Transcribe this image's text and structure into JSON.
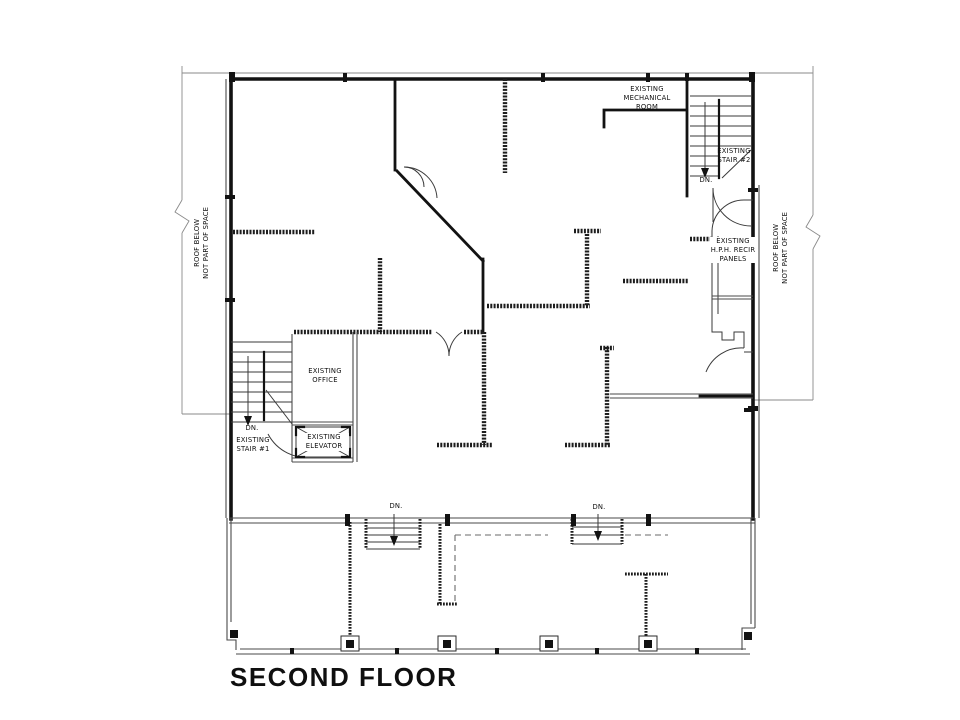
{
  "drawing": {
    "title": "SECOND FLOOR",
    "colors": {
      "line": "#121212",
      "background": "#ffffff"
    },
    "labels": {
      "mech_room": "EXISTING\nMECHANICAL\nROOM",
      "stair2": "EXISTING\nSTAIR #2",
      "stair2_dn": "DN.",
      "roof_left": "ROOF BELOW\nNOT PART OF SPACE",
      "roof_right": "ROOF BELOW\nNOT PART OF SPACE",
      "panels": "EXISTING\nH.P.H. RECIR\nPANELS",
      "office": "EXISTING\nOFFICE",
      "stair1_dn": "DN.",
      "stair1": "EXISTING\nSTAIR #1",
      "elevator": "EXISTING\nELEVATOR",
      "porch_dn_left": "DN.",
      "porch_dn_right": "DN."
    }
  }
}
